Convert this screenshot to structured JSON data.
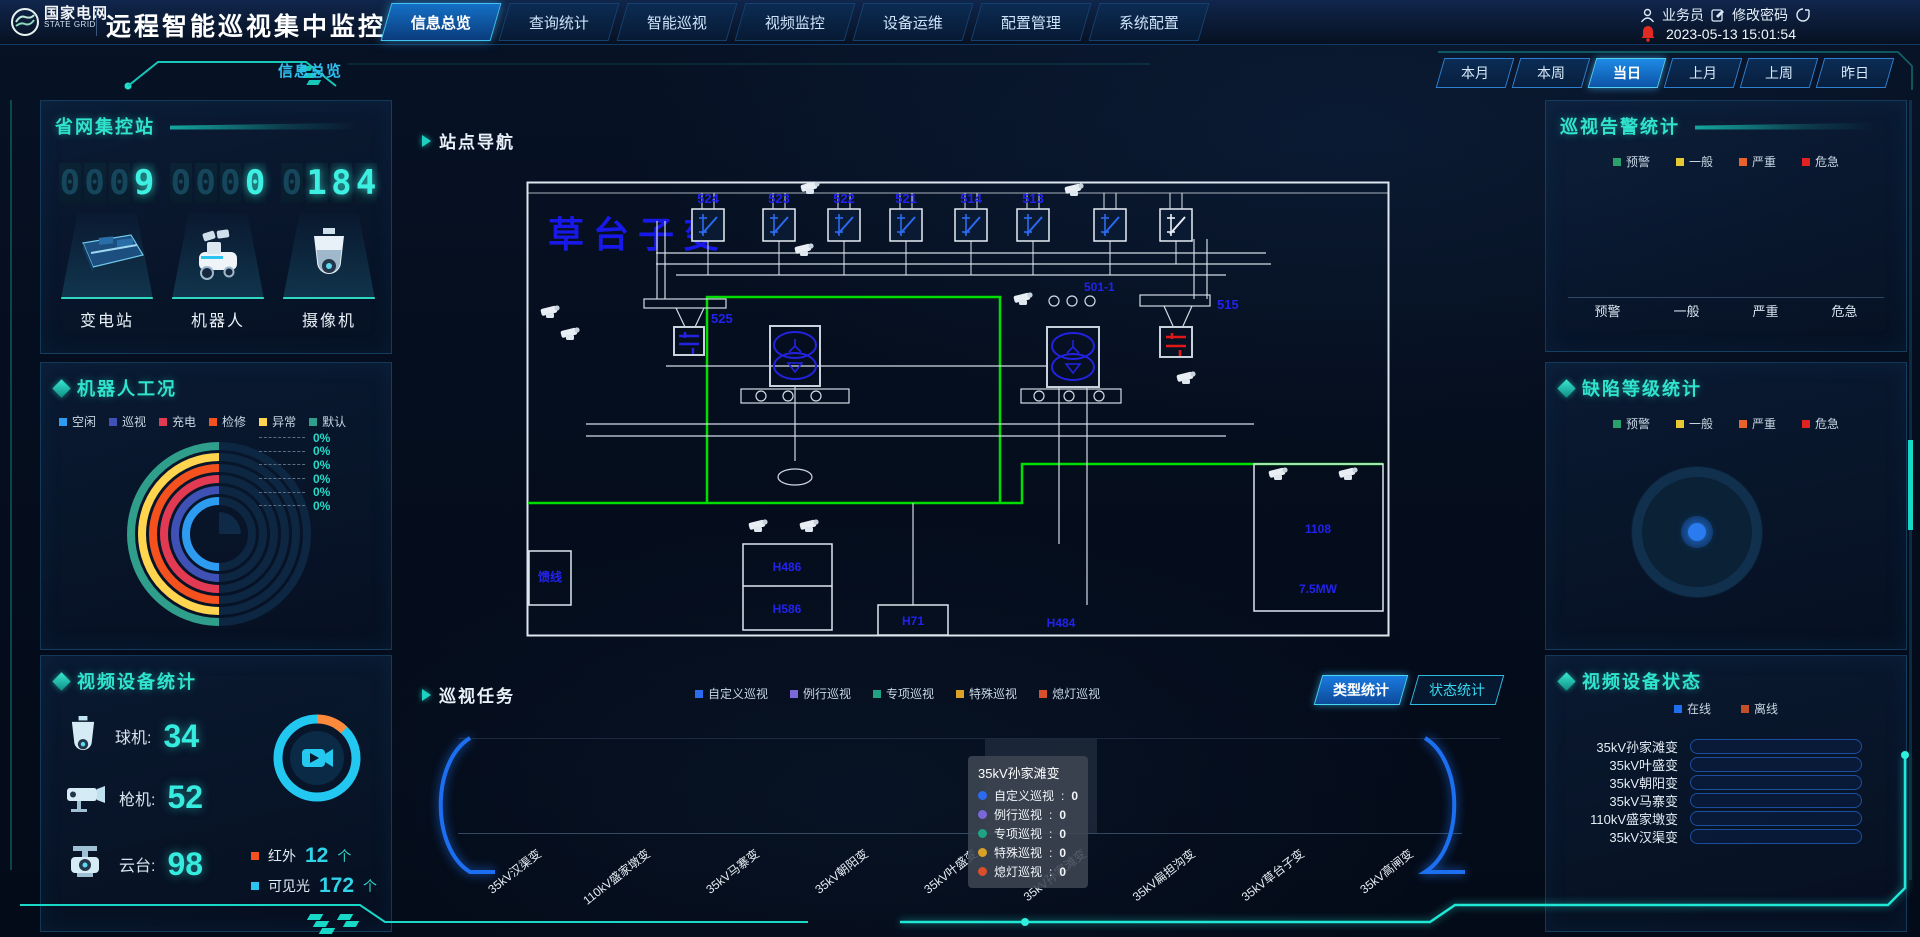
{
  "header": {
    "brand_cn": "国家电网",
    "brand_en": "STATE GRID",
    "app_title": "远程智能巡视集中监控系统",
    "tabs": [
      {
        "label": "信息总览",
        "active": true
      },
      {
        "label": "查询统计",
        "active": false
      },
      {
        "label": "智能巡视",
        "active": false
      },
      {
        "label": "视频监控",
        "active": false
      },
      {
        "label": "设备运维",
        "active": false
      },
      {
        "label": "配置管理",
        "active": false
      },
      {
        "label": "系统配置",
        "active": false
      }
    ],
    "user_label": "业务员",
    "change_password_label": "修改密码",
    "datetime": "2023-05-13 15:01:54"
  },
  "breadcrumb": "信息总览",
  "time_filters": [
    {
      "label": "本月",
      "active": false
    },
    {
      "label": "本周",
      "active": false
    },
    {
      "label": "当日",
      "active": true
    },
    {
      "label": "上月",
      "active": false
    },
    {
      "label": "上周",
      "active": false
    },
    {
      "label": "昨日",
      "active": false
    }
  ],
  "left": {
    "grid_stations": {
      "title": "省网集控站",
      "counters": [
        {
          "value": "0009",
          "bright": 1,
          "label": "变电站"
        },
        {
          "value": "0000",
          "bright": 1,
          "label": "机器人"
        },
        {
          "value": "0184",
          "bright": 3,
          "label": "摄像机"
        }
      ]
    },
    "robot_condition": {
      "title": "机器人工况",
      "legend": [
        {
          "label": "空闲",
          "color": "#2d9bf0"
        },
        {
          "label": "巡视",
          "color": "#3f51b5"
        },
        {
          "label": "充电",
          "color": "#e23a52"
        },
        {
          "label": "检修",
          "color": "#f4511e"
        },
        {
          "label": "异常",
          "color": "#ffd54f"
        },
        {
          "label": "默认",
          "color": "#2f9e8a"
        }
      ],
      "chart_data": {
        "type": "ring-gauge",
        "series": [
          {
            "name": "空闲",
            "pct": 0
          },
          {
            "name": "巡视",
            "pct": 0
          },
          {
            "name": "充电",
            "pct": 0
          },
          {
            "name": "检修",
            "pct": 0
          },
          {
            "name": "异常",
            "pct": 0
          },
          {
            "name": "默认",
            "pct": 0
          }
        ],
        "labels": [
          "0%",
          "0%",
          "0%",
          "0%",
          "0%",
          "0%"
        ]
      }
    },
    "video_stats": {
      "title": "视频设备统计",
      "devices": [
        {
          "label": "球机",
          "value": "34"
        },
        {
          "label": "枪机",
          "value": "52"
        },
        {
          "label": "云台",
          "value": "98"
        }
      ],
      "spectrum": [
        {
          "label": "红外",
          "value": "12",
          "unit": "个",
          "color": "#f4511e"
        },
        {
          "label": "可见光",
          "value": "172",
          "unit": "个",
          "color": "#29c4f0"
        }
      ]
    }
  },
  "center": {
    "site_nav": {
      "title": "站点导航",
      "station_name": "草台子变",
      "switch_labels": [
        "524",
        "523",
        "522",
        "521",
        "514",
        "513"
      ],
      "labels": {
        "l525": "525",
        "l501": "501-1",
        "l515": "515",
        "feeder": "馈线",
        "h486": "H486",
        "h586": "H586",
        "h71": "H71",
        "h484": "H484",
        "box_top": "1108",
        "box_bottom": "7.5MW"
      }
    },
    "patrol_tasks": {
      "title": "巡视任务",
      "legend": [
        {
          "label": "自定义巡视",
          "color": "#2b6bf0"
        },
        {
          "label": "例行巡视",
          "color": "#7b68d8"
        },
        {
          "label": "专项巡视",
          "color": "#1fa383"
        },
        {
          "label": "特殊巡视",
          "color": "#d9a226"
        },
        {
          "label": "熄灯巡视",
          "color": "#d94f2b"
        }
      ],
      "view_buttons": [
        {
          "label": "类型统计",
          "active": true
        },
        {
          "label": "状态统计",
          "active": false
        }
      ],
      "tooltip": {
        "station": "35kV孙家滩变",
        "rows": [
          {
            "label": "自定义巡视",
            "value": 0,
            "color": "#2b6bf0"
          },
          {
            "label": "例行巡视",
            "value": 0,
            "color": "#7b68d8"
          },
          {
            "label": "专项巡视",
            "value": 0,
            "color": "#1fa383"
          },
          {
            "label": "特殊巡视",
            "value": 0,
            "color": "#d9a226"
          },
          {
            "label": "熄灯巡视",
            "value": 0,
            "color": "#d94f2b"
          }
        ]
      },
      "chart_data": {
        "type": "bar",
        "categories": [
          "35kV汉渠变",
          "110kV盛家墩变",
          "35kV马寨变",
          "35kV朝阳变",
          "35kV叶盛变",
          "35kV孙家滩变",
          "35kV扁担沟变",
          "35kV草台子变",
          "35kV高闸变"
        ],
        "series": [
          {
            "name": "自定义巡视",
            "values": [
              0,
              0,
              0,
              0,
              0,
              0,
              0,
              0,
              0
            ]
          },
          {
            "name": "例行巡视",
            "values": [
              0,
              0,
              0,
              0,
              0,
              0,
              0,
              0,
              0
            ]
          },
          {
            "name": "专项巡视",
            "values": [
              0,
              0,
              0,
              0,
              0,
              0,
              0,
              0,
              0
            ]
          },
          {
            "name": "特殊巡视",
            "values": [
              0,
              0,
              0,
              0,
              0,
              0,
              0,
              0,
              0
            ]
          },
          {
            "name": "熄灯巡视",
            "values": [
              0,
              0,
              0,
              0,
              0,
              0,
              0,
              0,
              0
            ]
          }
        ]
      }
    }
  },
  "right": {
    "alarm_stats": {
      "title": "巡视告警统计",
      "legend": [
        {
          "label": "预警",
          "color": "#2aa06a"
        },
        {
          "label": "一般",
          "color": "#e8c832"
        },
        {
          "label": "严重",
          "color": "#e8622a"
        },
        {
          "label": "危急",
          "color": "#e02222"
        }
      ],
      "chart_data": {
        "type": "bar",
        "categories": [
          "预警",
          "一般",
          "严重",
          "危急"
        ],
        "values": [
          0,
          0,
          0,
          0
        ]
      }
    },
    "defect_stats": {
      "title": "缺陷等级统计",
      "legend": [
        {
          "label": "预警",
          "color": "#2aa06a"
        },
        {
          "label": "一般",
          "color": "#e8c832"
        },
        {
          "label": "严重",
          "color": "#e8622a"
        },
        {
          "label": "危急",
          "color": "#e02222"
        }
      ],
      "chart_data": {
        "type": "pie",
        "slices": [
          {
            "name": "预警",
            "value": 0
          },
          {
            "name": "一般",
            "value": 0
          },
          {
            "name": "严重",
            "value": 0
          },
          {
            "name": "危急",
            "value": 0
          }
        ]
      }
    },
    "device_status": {
      "title": "视频设备状态",
      "legend": [
        {
          "label": "在线",
          "color": "#1e6ef0"
        },
        {
          "label": "离线",
          "color": "#c4502a"
        }
      ],
      "chart_data": {
        "type": "bar-horizontal",
        "categories": [
          "35kV孙家滩变",
          "35kV叶盛变",
          "35kV朝阳变",
          "35kV马寨变",
          "110kV盛家墩变",
          "35kV汉渠变"
        ],
        "series": [
          {
            "name": "在线",
            "values_pct": [
              25,
              18,
              22,
              27,
              83,
              22
            ]
          }
        ]
      }
    }
  }
}
